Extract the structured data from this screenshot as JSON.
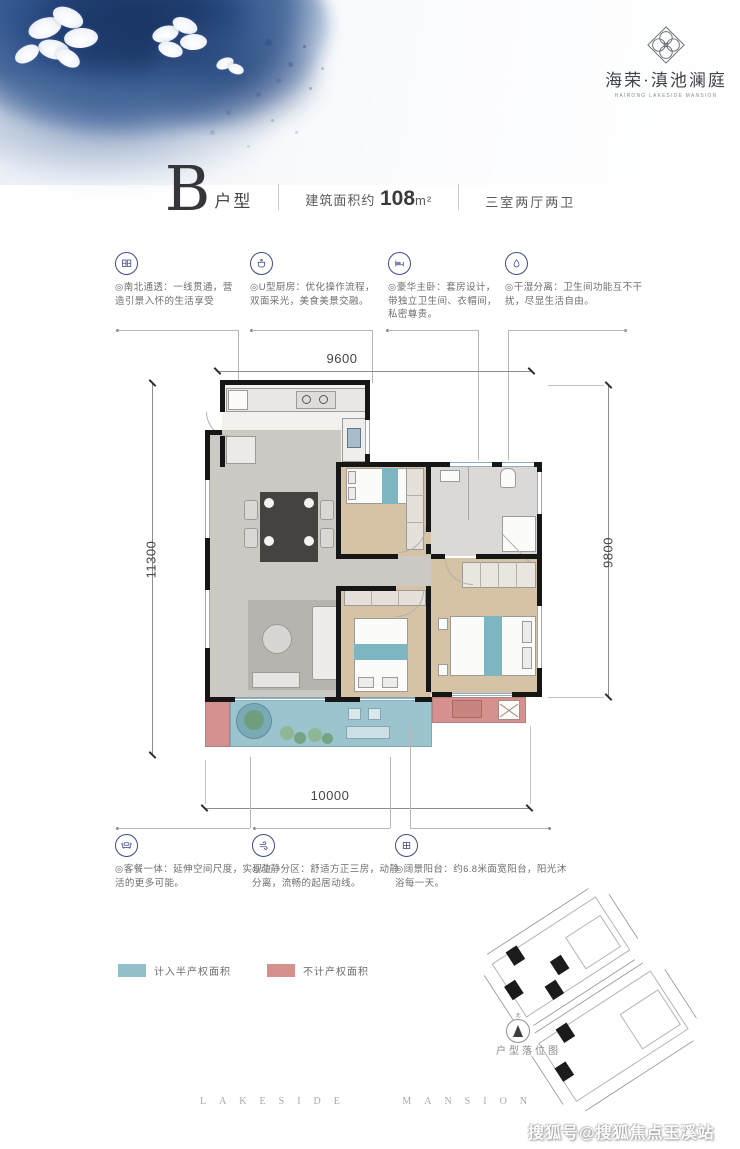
{
  "brand": {
    "logo_cn": "海荣·滇池澜庭",
    "logo_en": "HAIRONG LAKESIDE MANSION",
    "logo_icon": "diamond-lotus-icon"
  },
  "title": {
    "letter": "B",
    "suffix": "户型",
    "area_prefix": "建筑面积约",
    "area_value": "108",
    "area_unit": "m²",
    "rooms": "三室两厅两卫"
  },
  "features_top": [
    {
      "icon": "window-panels-icon",
      "text": "◎南北通透：一线贯通，营造引景入怀的生活享受"
    },
    {
      "icon": "cooking-pot-icon",
      "text": "◎U型厨房：优化操作流程，双面采光，美食美景交融。"
    },
    {
      "icon": "bed-icon",
      "text": "◎豪华主卧：套房设计，带独立卫生间、衣帽间，私密尊贵。"
    },
    {
      "icon": "water-drop-icon",
      "text": "◎干湿分离：卫生间功能互不干扰，尽显生活自由。"
    }
  ],
  "features_bottom": [
    {
      "icon": "sofa-icon",
      "text": "◎客餐一体：延伸空间尺度，实现生活的更多可能。"
    },
    {
      "icon": "wind-icon",
      "text": "◎动静分区：舒适方正三房，动静分离，流畅的起居动线。"
    },
    {
      "icon": "window-grid-icon",
      "text": "◎阔景阳台：约6.8米面宽阳台，阳光沐浴每一天。"
    }
  ],
  "plan_dimensions": {
    "top": "9600",
    "left": "11300",
    "right": "9800",
    "bottom": "10000"
  },
  "legend": {
    "items": [
      {
        "label": "计入半产权面积",
        "color": "#93bfca",
        "swatch_style": "background:#93bfca"
      },
      {
        "label": "不计产权面积",
        "color": "#d6918e",
        "swatch_style": "background:#d6918e"
      }
    ]
  },
  "siteplan": {
    "label": "户型落位图",
    "compass_north": "北"
  },
  "footer": {
    "text": "LAKESIDE MANSION"
  },
  "watermark": "搜狐号@搜狐焦点玉溪站",
  "colors": {
    "accent_navy": "#3d4a86",
    "watercolor_blue": "#2c4d86",
    "balcony_teal": "#93bfca",
    "non_property_pink": "#d6918e",
    "wall_black": "#161616",
    "wood_floor": "#d3bf9f",
    "tile_gray": "#ccc9c4"
  }
}
